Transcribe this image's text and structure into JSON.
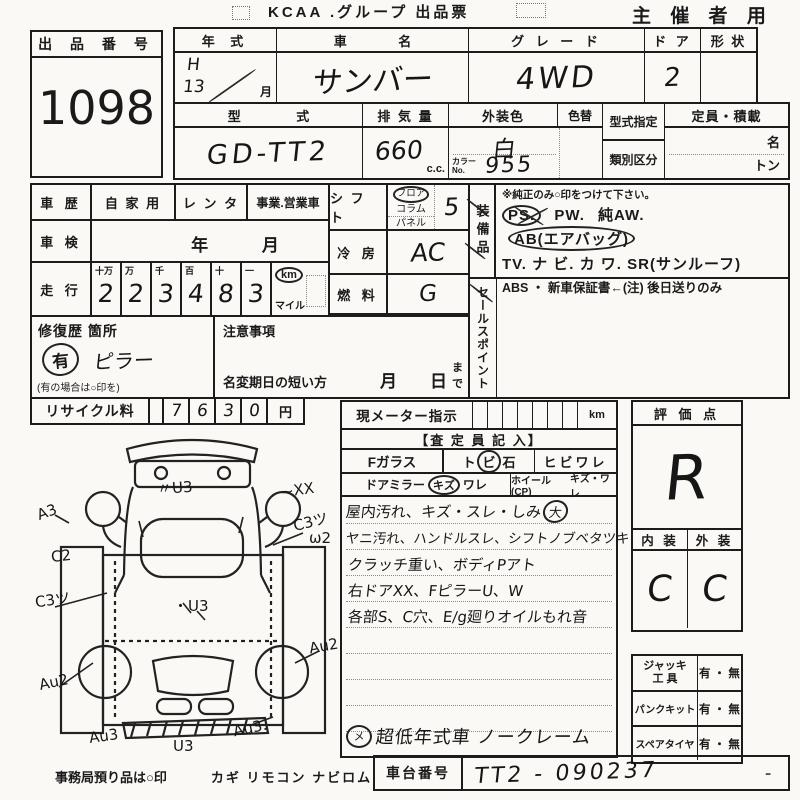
{
  "header": {
    "title": "KCAA .グループ 出品票",
    "audience": "主 催 者 用"
  },
  "auction_no": {
    "label": "出 品 番 号",
    "value": "1098"
  },
  "row1": {
    "year_label": "年 式",
    "year_era": "H",
    "year_num": "13",
    "year_month": "月",
    "name_label": "車 名",
    "name_value": "サンバー",
    "grade_label": "グ レ ー ド",
    "grade_value": "4WD",
    "door_label": "ド ア",
    "door_value": "2",
    "shape_label": "形 状"
  },
  "row2": {
    "model_label": "型 式",
    "model_value": "GD-TT2",
    "disp_label": "排 気 量",
    "disp_value": "660",
    "disp_unit": "c.c.",
    "color_label": "外装色",
    "color_value": "白",
    "color_change_label": "色替",
    "color_no_label1": "カラー",
    "color_no_label2": "No.",
    "color_no_value": "955",
    "type_desig_label": "型式指定",
    "class_label": "類別区分",
    "capacity_label": "定員・積載",
    "capacity_name": "名",
    "capacity_ton": "トン"
  },
  "history": {
    "label": "車 歴",
    "opt1": "自 家 用",
    "opt2": "レ ン タ",
    "opt3": "事業.営業車"
  },
  "inspection": {
    "label": "車 検",
    "year": "年",
    "month": "月"
  },
  "mileage": {
    "label": "走 行",
    "units": [
      "十万",
      "万",
      "千",
      "百",
      "十",
      "一"
    ],
    "digits": [
      "2",
      "2",
      "3",
      "4",
      "8",
      "3"
    ],
    "km": "km",
    "mile": "マイル"
  },
  "repair": {
    "label": "修復歴 箇所",
    "mark": "有",
    "location": "ピラー",
    "note": "(有の場合は○印を)"
  },
  "caution": {
    "label": "注意事項",
    "deadline": "名変期日の短い方",
    "month": "月",
    "day": "日",
    "made": "まで"
  },
  "recycle": {
    "label": "リサイクル料",
    "digits": [
      "7",
      "6",
      "3",
      "0"
    ],
    "unit": "円"
  },
  "shift": {
    "label": "シ フ ト",
    "opt1": "フロア",
    "opt2": "コラム",
    "opt3": "パネル",
    "value": "5"
  },
  "aircon": {
    "label": "冷 房",
    "value": "AC"
  },
  "fuel": {
    "label": "燃 料",
    "value": "G"
  },
  "equipment": {
    "label": "装備品",
    "note": "※純正のみ○印をつけて下さい。",
    "ps": "PS.",
    "pw": "PW.",
    "aw": "純AW.",
    "ab": "AB(エアバッグ)",
    "line2": "TV. ナ ビ. カ ワ. SR(サンルーフ)",
    "line3": "ABS ・ 新車保証書←(注) 後日送りのみ"
  },
  "sales_point": {
    "label": "セールスポイント"
  },
  "meter": {
    "label": "現メーター指示",
    "unit": "km",
    "assessor": "【査 定 員 記 入】",
    "fglass": "Fガラス",
    "fg_opt1": "ト",
    "fg_opt2": "ビ",
    "fg_opt3": "石",
    "fg_opt4": "ヒビワレ",
    "mirror": "ドアミラー",
    "mirror_kizu": "キズ",
    "mirror_ware": "ワレ",
    "wheel": "ホイール(CP)",
    "wheel_opt": "キズ・ワレ"
  },
  "comments": {
    "line1": "屋内汚れ、キズ・スレ・しみ",
    "line1_badge": "大",
    "line2": "ヤニ汚れ、ハンドルスレ、シフトノブベタツキ",
    "line3": "クラッチ重い、ボディPアト",
    "line4": "右ドアXX、FピラーU、W",
    "line5": "各部S、C穴、E/g廻りオイルもれ音",
    "final": "超低年式車 ノークレーム"
  },
  "evaluation": {
    "label": "評 価 点",
    "score": "R",
    "interior_label": "内 装",
    "exterior_label": "外 装",
    "interior": "C",
    "exterior": "C"
  },
  "tools": {
    "jack1": "ジャッキ",
    "jack2": "工 具",
    "jack_value": "有 ・ 無",
    "punk": "パンクキット",
    "punk_value": "有 ・ 無",
    "spare": "スペアタイヤ",
    "spare_value": "有 ・ 無"
  },
  "chassis": {
    "label": "車台番号",
    "value": "TT2 - 090237",
    "suffix": "-"
  },
  "footer": {
    "note": "事務局預り品は○印",
    "items": "カギ リモコン ナビロム"
  },
  "diagram": {
    "annotations": [
      {
        "text": "〃U3",
        "x": 122,
        "y": 52,
        "r": -4
      },
      {
        "text": "~XX",
        "x": 246,
        "y": 56,
        "r": -8
      },
      {
        "text": "A3",
        "x": 2,
        "y": 78,
        "r": -20
      },
      {
        "text": "C3ツ",
        "x": 258,
        "y": 86,
        "r": -14
      },
      {
        "text": "ω2",
        "x": 274,
        "y": 104,
        "r": 0
      },
      {
        "text": "C2",
        "x": 16,
        "y": 122,
        "r": -6
      },
      {
        "text": "C3ツ",
        "x": 0,
        "y": 164,
        "r": -8
      },
      {
        "text": "・U3",
        "x": 138,
        "y": 170,
        "r": 0
      },
      {
        "text": "Au2",
        "x": 4,
        "y": 248,
        "r": -12
      },
      {
        "text": "Au2",
        "x": 274,
        "y": 212,
        "r": -10
      },
      {
        "text": "Au3",
        "x": 54,
        "y": 302,
        "r": -8
      },
      {
        "text": "U3",
        "x": 138,
        "y": 312,
        "r": 0
      },
      {
        "text": "Au3.",
        "x": 198,
        "y": 294,
        "r": -12
      }
    ]
  }
}
